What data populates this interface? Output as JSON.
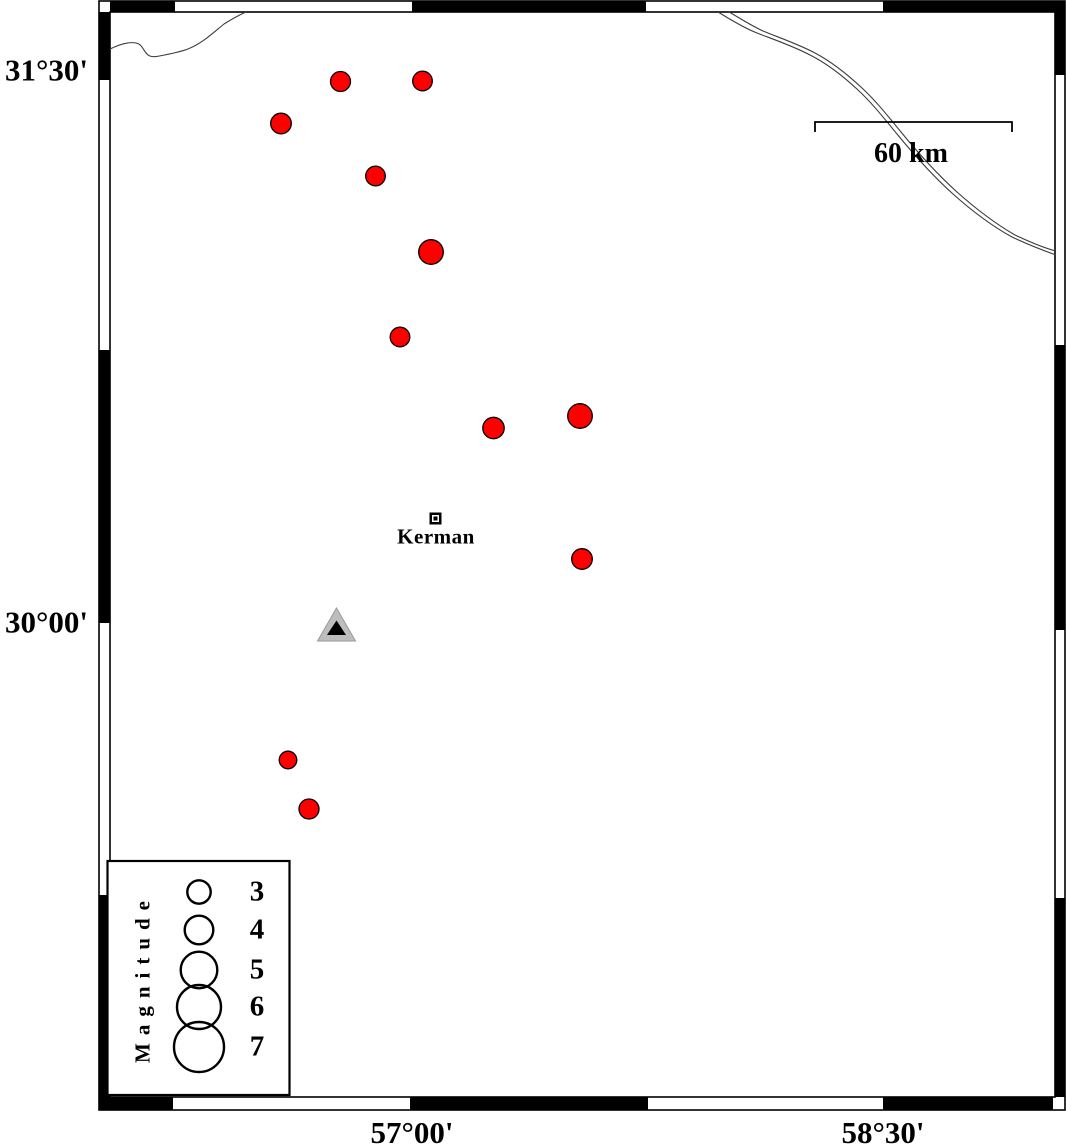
{
  "map": {
    "lat_labels": [
      {
        "text": "31°30'",
        "y": 70
      },
      {
        "text": "30°00'",
        "y": 622
      }
    ],
    "lon_labels": [
      {
        "text": "57°00'",
        "x": 412
      },
      {
        "text": "58°30'",
        "x": 883
      }
    ],
    "scale_bar": {
      "label": "60 km",
      "x1": 815,
      "x2": 1012,
      "y": 122,
      "tick": 10
    },
    "city": {
      "label": "Kerman",
      "x": 435.5,
      "y": 518.5
    },
    "station": {
      "x": 336.5,
      "y_apex": 608,
      "y_base": 641,
      "half_w": 19,
      "fill": "#bdbdbd"
    },
    "event_color": "#ff0000",
    "events": [
      {
        "x": 340.5,
        "y": 81.5,
        "r": 10
      },
      {
        "x": 422.5,
        "y": 81,
        "r": 9.8
      },
      {
        "x": 281,
        "y": 123.5,
        "r": 10.3
      },
      {
        "x": 375.5,
        "y": 176,
        "r": 9.8
      },
      {
        "x": 431,
        "y": 252,
        "r": 12.3
      },
      {
        "x": 400,
        "y": 337,
        "r": 9.8
      },
      {
        "x": 493.5,
        "y": 428,
        "r": 10.7
      },
      {
        "x": 580,
        "y": 416,
        "r": 12.3
      },
      {
        "x": 582,
        "y": 559,
        "r": 10.3
      },
      {
        "x": 288,
        "y": 760,
        "r": 8.8
      },
      {
        "x": 309,
        "y": 809,
        "r": 10
      }
    ],
    "river_color": "#3c3c3c",
    "rivers": [
      "M110,49 C118,45 128,41.5 136,43 C142,44 143,50 147,54 C150,57.5 155,57 162,55.5 C172,53.5 180,52 188,49 C203,43 214,32 224,24 C232,19 239,15 246,12",
      "M718,12 C728,18 742,27 757,33 C775,40 793,46 810,55 C828,64 843,76 858,90 C872,103 883,117 897,134 C915,156 933,176 953,194 C972,211 992,226 1012,237 C1027,244 1042,250 1056,255",
      "M729,12 C738,17 750,25 763,31 C780,38 798,44 815,53 C832,62 847,74 862,88 C876,101 887,115 901,132 C919,154 937,174 957,192 C976,209 996,224 1015,235 C1030,242 1044,248 1056,251"
    ],
    "frame": {
      "outer": [
        99,
        1,
        1065,
        1110
      ],
      "inner": [
        110,
        12,
        1055,
        1097
      ],
      "top": [
        [
          110,
          175
        ],
        [
          412,
          646
        ],
        [
          883,
          1055
        ]
      ],
      "bottom": [
        [
          110,
          173
        ],
        [
          410,
          648
        ],
        [
          883,
          1053
        ]
      ],
      "left": [
        [
          12,
          80
        ],
        [
          350,
          623
        ],
        [
          895,
          1110
        ]
      ],
      "right": [
        [
          1,
          75
        ],
        [
          345,
          630
        ],
        [
          898,
          1097
        ]
      ]
    }
  },
  "legend": {
    "title": "Magnitude",
    "box": {
      "x": 107.5,
      "y": 861,
      "w": 182,
      "h": 234
    },
    "circle_cx": 199,
    "label_cx": 257,
    "items": [
      {
        "label": "3",
        "cy": 892,
        "r": 11.7
      },
      {
        "label": "4",
        "cy": 930,
        "r": 14.3
      },
      {
        "label": "5",
        "cy": 970,
        "r": 18.3
      },
      {
        "label": "6",
        "cy": 1007,
        "r": 22
      },
      {
        "label": "7",
        "cy": 1047,
        "r": 25
      }
    ]
  }
}
